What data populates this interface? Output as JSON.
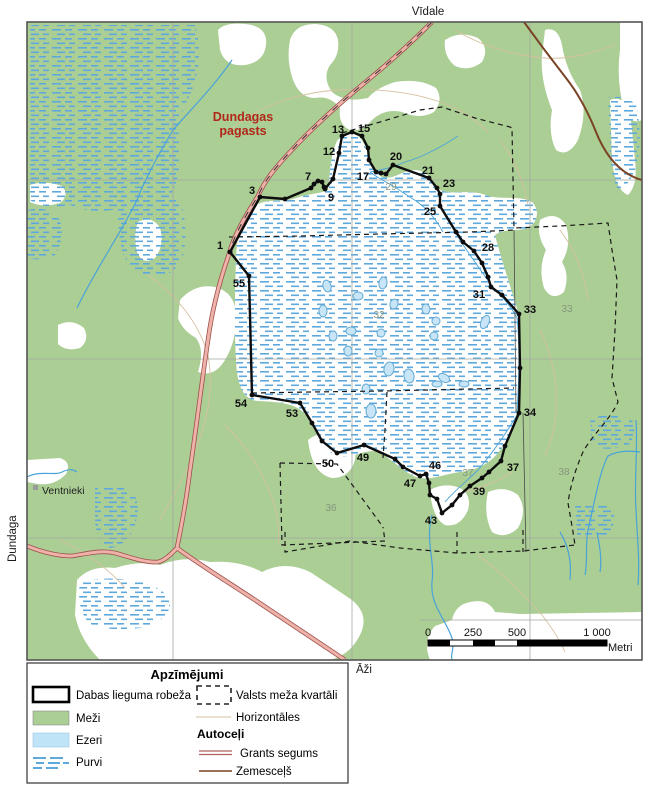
{
  "map": {
    "outer_labels": {
      "top": "Vīdale",
      "left": "Dundaga",
      "bottom": "Āži"
    },
    "region_label": {
      "line1": "Dundagas",
      "line2": "pagasts"
    },
    "place": "Ventnieki",
    "boundary_labels": [
      {
        "n": "1",
        "x": 220,
        "y": 249
      },
      {
        "n": "3",
        "x": 252,
        "y": 194
      },
      {
        "n": "7",
        "x": 308,
        "y": 180
      },
      {
        "n": "9",
        "x": 331,
        "y": 201
      },
      {
        "n": "12",
        "x": 329,
        "y": 155
      },
      {
        "n": "13",
        "x": 338,
        "y": 133
      },
      {
        "n": "15",
        "x": 364,
        "y": 132
      },
      {
        "n": "17",
        "x": 363,
        "y": 180
      },
      {
        "n": "20",
        "x": 396,
        "y": 160
      },
      {
        "n": "21",
        "x": 428,
        "y": 174
      },
      {
        "n": "23",
        "x": 449,
        "y": 187
      },
      {
        "n": "25",
        "x": 430,
        "y": 215
      },
      {
        "n": "28",
        "x": 488,
        "y": 251
      },
      {
        "n": "31",
        "x": 479,
        "y": 298
      },
      {
        "n": "33",
        "x": 530,
        "y": 313
      },
      {
        "n": "34",
        "x": 530,
        "y": 416
      },
      {
        "n": "37",
        "x": 513,
        "y": 471
      },
      {
        "n": "39",
        "x": 479,
        "y": 495
      },
      {
        "n": "43",
        "x": 431,
        "y": 524
      },
      {
        "n": "46",
        "x": 435,
        "y": 469
      },
      {
        "n": "47",
        "x": 410,
        "y": 487
      },
      {
        "n": "49",
        "x": 363,
        "y": 461
      },
      {
        "n": "50",
        "x": 328,
        "y": 467
      },
      {
        "n": "53",
        "x": 292,
        "y": 417
      },
      {
        "n": "54",
        "x": 241,
        "y": 407
      },
      {
        "n": "55",
        "x": 239,
        "y": 287
      }
    ],
    "boundary_vertices": [
      [
        230,
        252
      ],
      [
        260,
        197
      ],
      [
        285,
        199
      ],
      [
        311,
        188
      ],
      [
        314,
        184
      ],
      [
        318,
        181
      ],
      [
        322,
        182
      ],
      [
        324,
        187
      ],
      [
        325,
        189
      ],
      [
        333,
        179
      ],
      [
        339,
        153
      ],
      [
        342,
        136
      ],
      [
        352,
        132
      ],
      [
        362,
        136
      ],
      [
        368,
        148
      ],
      [
        369,
        160
      ],
      [
        376,
        172
      ],
      [
        381,
        173
      ],
      [
        386,
        174
      ],
      [
        393,
        165
      ],
      [
        429,
        178
      ],
      [
        437,
        188
      ],
      [
        440,
        194
      ],
      [
        440,
        206
      ],
      [
        456,
        232
      ],
      [
        463,
        242
      ],
      [
        474,
        251
      ],
      [
        482,
        263
      ],
      [
        488,
        277
      ],
      [
        491,
        287
      ],
      [
        502,
        295
      ],
      [
        519,
        314
      ],
      [
        520,
        368
      ],
      [
        519,
        413
      ],
      [
        505,
        446
      ],
      [
        501,
        461
      ],
      [
        489,
        472
      ],
      [
        482,
        478
      ],
      [
        470,
        486
      ],
      [
        460,
        495
      ],
      [
        452,
        505
      ],
      [
        442,
        513
      ],
      [
        437,
        499
      ],
      [
        430,
        495
      ],
      [
        429,
        483
      ],
      [
        426,
        474
      ],
      [
        420,
        476
      ],
      [
        403,
        467
      ],
      [
        395,
        459
      ],
      [
        364,
        445
      ],
      [
        337,
        453
      ],
      [
        322,
        441
      ],
      [
        312,
        423
      ],
      [
        300,
        403
      ],
      [
        252,
        395
      ],
      [
        249,
        276
      ],
      [
        230,
        252
      ]
    ],
    "block_numbers": [
      {
        "n": "29",
        "x": 391,
        "y": 190
      },
      {
        "n": "32",
        "x": 379,
        "y": 318
      },
      {
        "n": "33",
        "x": 567,
        "y": 312
      },
      {
        "n": "36",
        "x": 331,
        "y": 511
      },
      {
        "n": "37",
        "x": 468,
        "y": 476
      },
      {
        "n": "38",
        "x": 564,
        "y": 475
      }
    ],
    "colors": {
      "forest": "#abce95",
      "open": "#ffffff",
      "pond_fill": "#c7e5f6",
      "pond_stroke": "#64abd4",
      "bog_dash": "#5fa8dc",
      "stream": "#4aa3d8",
      "contour": "#d6c0a0",
      "grid": "#a2a8a0",
      "gravel_fill": "#eeb2aa",
      "gravel_casing": "#9c5149",
      "dirt_road": "#7a4326",
      "boundary": "#0d0d0d",
      "block_line": "#1a1a1a",
      "region_text": "#b1271a"
    }
  },
  "scalebar": {
    "ticks": [
      {
        "label": "0",
        "x": 428
      },
      {
        "label": "250",
        "x": 473
      },
      {
        "label": "500",
        "x": 517
      },
      {
        "label": "1 000",
        "x": 597
      }
    ],
    "unit": "Metri"
  },
  "legend": {
    "title": "Apzīmējumi",
    "items": {
      "boundary": "Dabas lieguma robeža",
      "forest": "Meži",
      "lakes": "Ezeri",
      "bogs": "Purvi",
      "blocks": "Valsts meža kvartāli",
      "contours": "Horizontāles"
    },
    "roads_header": "Autoceļi",
    "roads": {
      "gravel": "Grants segums",
      "dirt": "Zemesceļš"
    }
  }
}
